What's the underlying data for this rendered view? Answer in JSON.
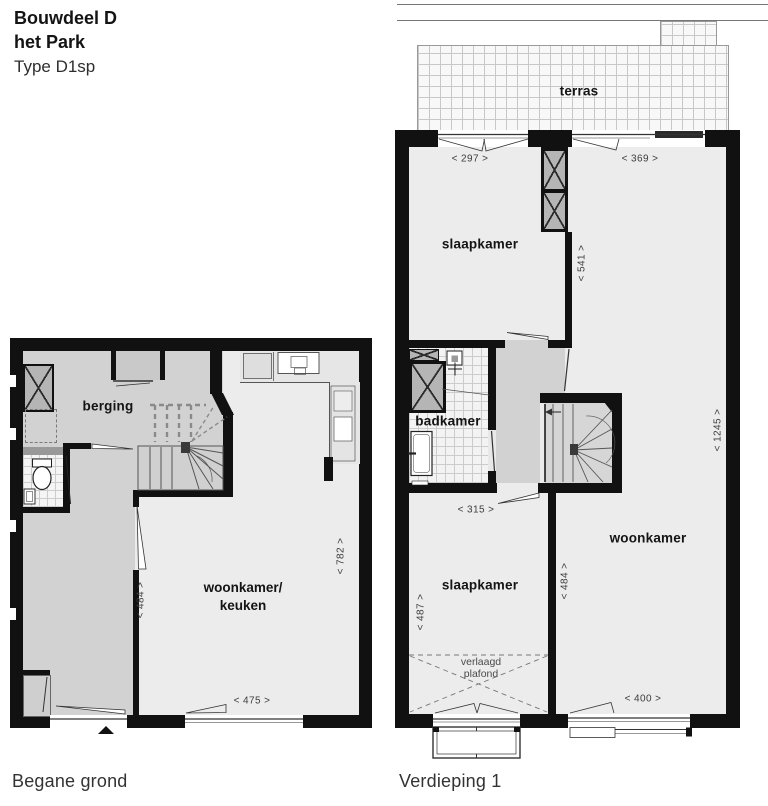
{
  "header": {
    "title_line1": "Bouwdeel D",
    "title_line2": "het Park",
    "subtitle": "Type D1sp"
  },
  "ground_floor": {
    "caption": "Begane grond",
    "labels": {
      "berging": "berging",
      "woonkamer_keuken_line1": "woonkamer/",
      "woonkamer_keuken_line2": "keuken"
    },
    "dimensions": {
      "hall_depth": "< 484 >",
      "room_depth": "< 782 >",
      "room_width": "< 475 >"
    }
  },
  "first_floor": {
    "caption": "Verdieping 1",
    "labels": {
      "terras": "terras",
      "slaapkamer_front": "slaapkamer",
      "badkamer": "badkamer",
      "woonkamer": "woonkamer",
      "slaapkamer_back": "slaapkamer",
      "verlaagd_line1": "verlaagd",
      "verlaagd_line2": "plafond"
    },
    "dimensions": {
      "slaapkamer_front_width": "< 297 >",
      "woonkamer_width_top": "< 369 >",
      "slaapkamer_front_depth": "< 541 >",
      "slaapkamer_back_width": "< 315 >",
      "slaapkamer_back_depth": "< 487 >",
      "woonkamer_depth_mid": "< 484 >",
      "woonkamer_width_bottom": "< 400 >",
      "total_depth": "< 1245 >"
    }
  },
  "colors": {
    "wall": "#111111",
    "room_light": "#ececec",
    "room_gray": "#d2d2d2",
    "shaft_gray": "#b5b5b5"
  }
}
